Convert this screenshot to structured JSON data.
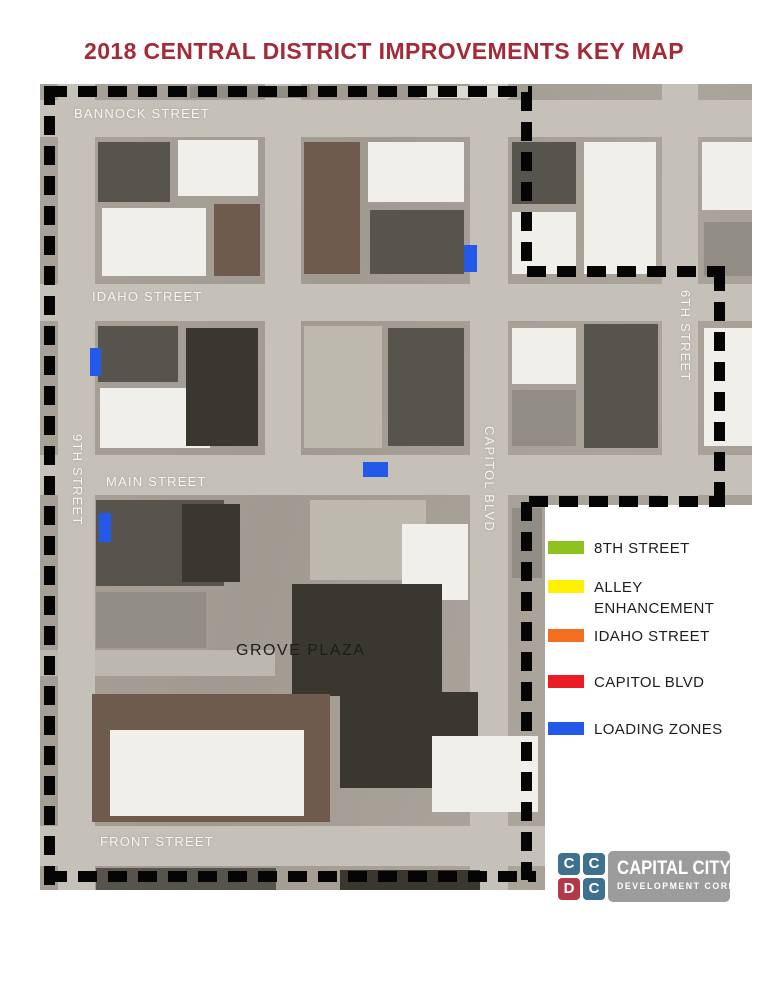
{
  "title": "2018 CENTRAL DISTRICT IMPROVEMENTS KEY MAP",
  "colors": {
    "title": "#A42A38",
    "dash": "#050505",
    "photo_base": "#A39D94",
    "street": "#C6C1B8",
    "street_minor": "#BDB8AF",
    "label_white": "#F7F6F2",
    "label_dark": "#1C1C1C",
    "loading_zone": "#2359E8",
    "logo_gray": "#9C9C9C"
  },
  "palette": {
    "w": "#F1EFE9",
    "lg": "#DCD9D2",
    "g": "#918C84",
    "dg": "#57534D",
    "db": "#3A372F",
    "br": "#6F5B4E",
    "t": "#BEB9AE"
  },
  "map": {
    "streets": [
      {
        "name": "bannock-street",
        "x": 0,
        "y": 16,
        "w": 712,
        "h": 37
      },
      {
        "name": "idaho-street",
        "x": 0,
        "y": 200,
        "w": 712,
        "h": 37
      },
      {
        "name": "main-street",
        "x": 0,
        "y": 371,
        "w": 712,
        "h": 40
      },
      {
        "name": "front-street",
        "x": 0,
        "y": 742,
        "w": 560,
        "h": 40
      },
      {
        "name": "grove-street",
        "x": 0,
        "y": 566,
        "w": 235,
        "h": 26,
        "minor": true
      },
      {
        "name": "9th-street",
        "x": 18,
        "y": 0,
        "w": 37,
        "h": 806
      },
      {
        "name": "8th-street",
        "x": 225,
        "y": 0,
        "w": 36,
        "h": 411
      },
      {
        "name": "capitol-blvd",
        "x": 430,
        "y": 0,
        "w": 38,
        "h": 806
      },
      {
        "name": "6th-street",
        "x": 622,
        "y": 0,
        "w": 36,
        "h": 806
      }
    ],
    "buildings": [
      {
        "x": 150,
        "y": 2,
        "w": 120,
        "h": 12,
        "c": "g"
      },
      {
        "x": 380,
        "y": 2,
        "w": 90,
        "h": 12,
        "c": "lg"
      },
      {
        "x": 58,
        "y": 58,
        "w": 72,
        "h": 60,
        "c": "dg"
      },
      {
        "x": 138,
        "y": 56,
        "w": 80,
        "h": 56,
        "c": "w"
      },
      {
        "x": 62,
        "y": 124,
        "w": 104,
        "h": 68,
        "c": "w"
      },
      {
        "x": 174,
        "y": 120,
        "w": 46,
        "h": 72,
        "c": "br"
      },
      {
        "x": 264,
        "y": 58,
        "w": 56,
        "h": 132,
        "c": "br"
      },
      {
        "x": 328,
        "y": 58,
        "w": 96,
        "h": 60,
        "c": "w"
      },
      {
        "x": 330,
        "y": 126,
        "w": 94,
        "h": 64,
        "c": "dg"
      },
      {
        "x": 472,
        "y": 58,
        "w": 64,
        "h": 62,
        "c": "dg"
      },
      {
        "x": 544,
        "y": 58,
        "w": 72,
        "h": 132,
        "c": "w"
      },
      {
        "x": 472,
        "y": 128,
        "w": 64,
        "h": 62,
        "c": "w"
      },
      {
        "x": 662,
        "y": 58,
        "w": 50,
        "h": 68,
        "c": "w"
      },
      {
        "x": 664,
        "y": 138,
        "w": 48,
        "h": 54,
        "c": "g"
      },
      {
        "x": 58,
        "y": 242,
        "w": 80,
        "h": 56,
        "c": "dg"
      },
      {
        "x": 60,
        "y": 304,
        "w": 110,
        "h": 60,
        "c": "w"
      },
      {
        "x": 146,
        "y": 244,
        "w": 72,
        "h": 118,
        "c": "db"
      },
      {
        "x": 264,
        "y": 242,
        "w": 78,
        "h": 122,
        "c": "t"
      },
      {
        "x": 348,
        "y": 244,
        "w": 76,
        "h": 118,
        "c": "dg"
      },
      {
        "x": 472,
        "y": 244,
        "w": 64,
        "h": 56,
        "c": "w"
      },
      {
        "x": 544,
        "y": 240,
        "w": 74,
        "h": 124,
        "c": "dg"
      },
      {
        "x": 472,
        "y": 306,
        "w": 64,
        "h": 56,
        "c": "g"
      },
      {
        "x": 664,
        "y": 244,
        "w": 48,
        "h": 118,
        "c": "w"
      },
      {
        "x": 56,
        "y": 416,
        "w": 128,
        "h": 86,
        "c": "dg"
      },
      {
        "x": 142,
        "y": 420,
        "w": 58,
        "h": 78,
        "c": "db"
      },
      {
        "x": 270,
        "y": 416,
        "w": 116,
        "h": 80,
        "c": "t"
      },
      {
        "x": 362,
        "y": 440,
        "w": 66,
        "h": 76,
        "c": "w"
      },
      {
        "x": 252,
        "y": 500,
        "w": 150,
        "h": 112,
        "c": "db"
      },
      {
        "x": 56,
        "y": 508,
        "w": 110,
        "h": 56,
        "c": "g"
      },
      {
        "x": 472,
        "y": 424,
        "w": 30,
        "h": 70,
        "c": "g"
      },
      {
        "x": 52,
        "y": 610,
        "w": 238,
        "h": 128,
        "c": "br"
      },
      {
        "x": 70,
        "y": 646,
        "w": 194,
        "h": 86,
        "c": "w"
      },
      {
        "x": 300,
        "y": 608,
        "w": 138,
        "h": 96,
        "c": "db"
      },
      {
        "x": 392,
        "y": 652,
        "w": 106,
        "h": 76,
        "c": "w"
      },
      {
        "x": 56,
        "y": 784,
        "w": 180,
        "h": 22,
        "c": "dg"
      },
      {
        "x": 300,
        "y": 786,
        "w": 140,
        "h": 20,
        "c": "db"
      }
    ],
    "loading_zones": [
      {
        "x": 424,
        "y": 161,
        "w": 13,
        "h": 27
      },
      {
        "x": 50,
        "y": 264,
        "w": 11,
        "h": 28
      },
      {
        "x": 323,
        "y": 378,
        "w": 25,
        "h": 15
      },
      {
        "x": 59,
        "y": 429,
        "w": 12,
        "h": 29
      }
    ],
    "labels": [
      {
        "text": "BANNOCK STREET",
        "x": 34,
        "y": 22,
        "dir": "h"
      },
      {
        "text": "IDAHO STREET",
        "x": 52,
        "y": 205,
        "dir": "h"
      },
      {
        "text": "MAIN STREET",
        "x": 66,
        "y": 390,
        "dir": "h"
      },
      {
        "text": "FRONT STREET",
        "x": 60,
        "y": 750,
        "dir": "h"
      },
      {
        "text": "GROVE PLAZA",
        "x": 196,
        "y": 558,
        "dir": "h",
        "dark": true
      },
      {
        "text": "9TH STREET",
        "x": 30,
        "y": 350,
        "dir": "v"
      },
      {
        "text": "CAPITOL BLVD",
        "x": 442,
        "y": 342,
        "dir": "v"
      },
      {
        "text": "6TH STREET",
        "x": 638,
        "y": 206,
        "dir": "v"
      }
    ],
    "boundary": [
      {
        "dir": "h",
        "x": 48,
        "y": 86,
        "w": 484,
        "h": 11
      },
      {
        "dir": "v",
        "x": 44,
        "y": 86,
        "w": 11,
        "h": 799
      },
      {
        "dir": "v",
        "x": 521,
        "y": 92,
        "w": 11,
        "h": 180
      },
      {
        "dir": "h",
        "x": 527,
        "y": 266,
        "w": 198,
        "h": 11
      },
      {
        "dir": "v",
        "x": 714,
        "y": 272,
        "w": 11,
        "h": 230
      },
      {
        "dir": "h",
        "x": 529,
        "y": 496,
        "w": 196,
        "h": 11
      },
      {
        "dir": "v",
        "x": 521,
        "y": 502,
        "w": 11,
        "h": 378
      },
      {
        "dir": "h",
        "x": 48,
        "y": 871,
        "w": 488,
        "h": 11
      }
    ]
  },
  "legend": {
    "items": [
      {
        "label": "8TH STREET",
        "color": "#8DC21F",
        "top": 541
      },
      {
        "label": "ALLEY ENHANCEMENT",
        "color": "#FFF104",
        "top": 580
      },
      {
        "label": "IDAHO STREET",
        "color": "#F36F1F",
        "top": 629
      },
      {
        "label": "CAPITOL BLVD",
        "color": "#EC1C24",
        "top": 675
      },
      {
        "label": "LOADING ZONES",
        "color": "#2359E8",
        "top": 722
      }
    ]
  },
  "logo": {
    "tiles": [
      {
        "letter": "C",
        "color": "#3E708F"
      },
      {
        "letter": "C",
        "color": "#3E708F"
      },
      {
        "letter": "D",
        "color": "#B13A49"
      },
      {
        "letter": "C",
        "color": "#3E708F"
      }
    ],
    "line1": "CAPITAL CITY",
    "line2": "DEVELOPMENT CORP"
  }
}
